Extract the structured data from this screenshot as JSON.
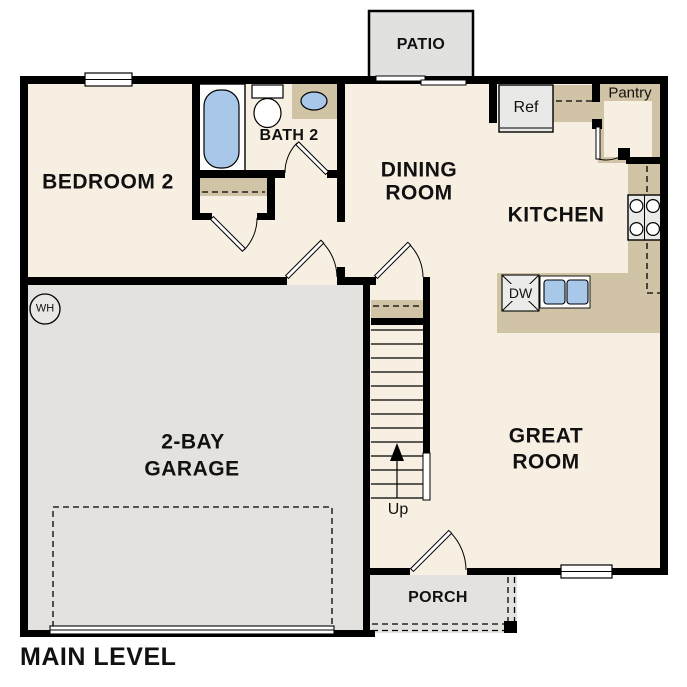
{
  "plan": {
    "title": "MAIN LEVEL",
    "rooms": {
      "patio": "PATIO",
      "bedroom2": "BEDROOM 2",
      "bath2": "BATH 2",
      "dining_line1": "DINING",
      "dining_line2": "ROOM",
      "kitchen": "KITCHEN",
      "great_line1": "GREAT",
      "great_line2": "ROOM",
      "garage_line1": "2-BAY",
      "garage_line2": "GARAGE",
      "porch": "PORCH"
    },
    "fixtures": {
      "pantry": "Pantry",
      "refrigerator": "Ref",
      "dishwasher": "DW",
      "stairs_direction": "Up",
      "water_heater": "WH"
    },
    "colors": {
      "floor": "#f7efe1",
      "counter_tan": "#d1c3a5",
      "concrete_gray": "#e3e2df",
      "appliance_gray": "#e9e9e7",
      "fixture_blue": "#a9c8e9",
      "wall": "#000000"
    }
  }
}
